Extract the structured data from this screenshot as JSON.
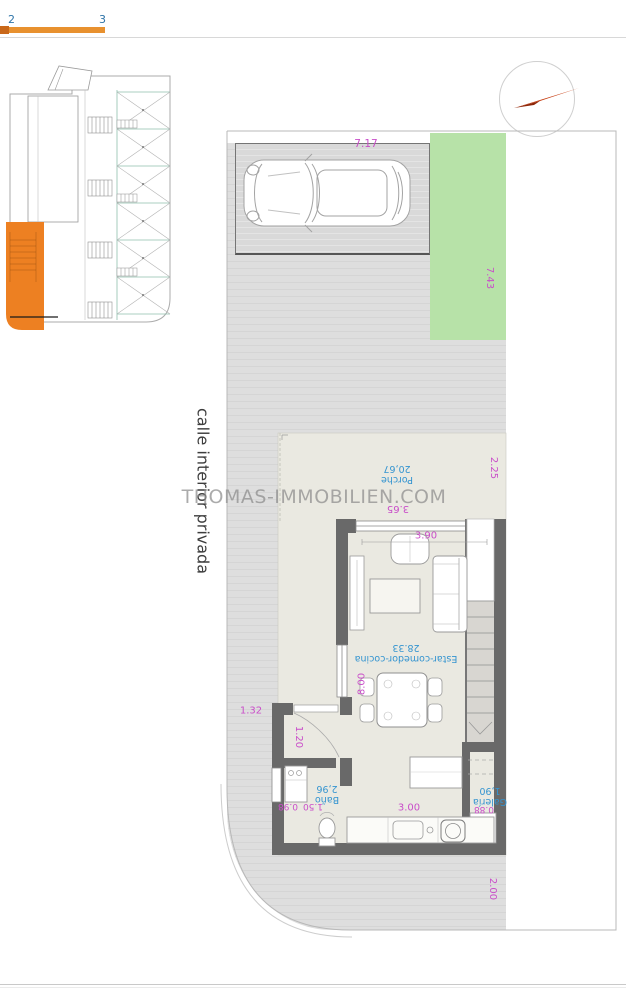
{
  "page": {
    "tabs": {
      "left": "2",
      "right": "3"
    },
    "watermark": "THOMAS-IMMOBILIEN.COM",
    "street_label": "calle interior privada"
  },
  "floor_plan": {
    "rooms": {
      "porche": {
        "label": "Porche",
        "area": "20,67"
      },
      "living": {
        "label": "Estar-comedor-cocina",
        "area": "28.33"
      },
      "bathroom": {
        "label": "Baño",
        "area": "2,96"
      },
      "gallery": {
        "label": "Galería",
        "area": "1,90"
      }
    },
    "dimensions": {
      "parking_width": "7.17",
      "garden_depth": "7.43",
      "porch_side": "2.25",
      "porch_width": "3.65",
      "living_width": "3.90",
      "living_depth": "8.00",
      "side_path": "1.32",
      "hall_width": "1.20",
      "bath_width": "0.98",
      "bath_length": "1.50",
      "kitchen_width": "3.00",
      "gallery_width": "0.88",
      "rear_margin": "2.00"
    }
  },
  "colors": {
    "highlight_orange": "#ed8022",
    "garden_green": "#b7e2a8",
    "dimension_magenta": "#c94ec9",
    "room_label_blue": "#3494d0",
    "wall_gray": "#696969"
  }
}
